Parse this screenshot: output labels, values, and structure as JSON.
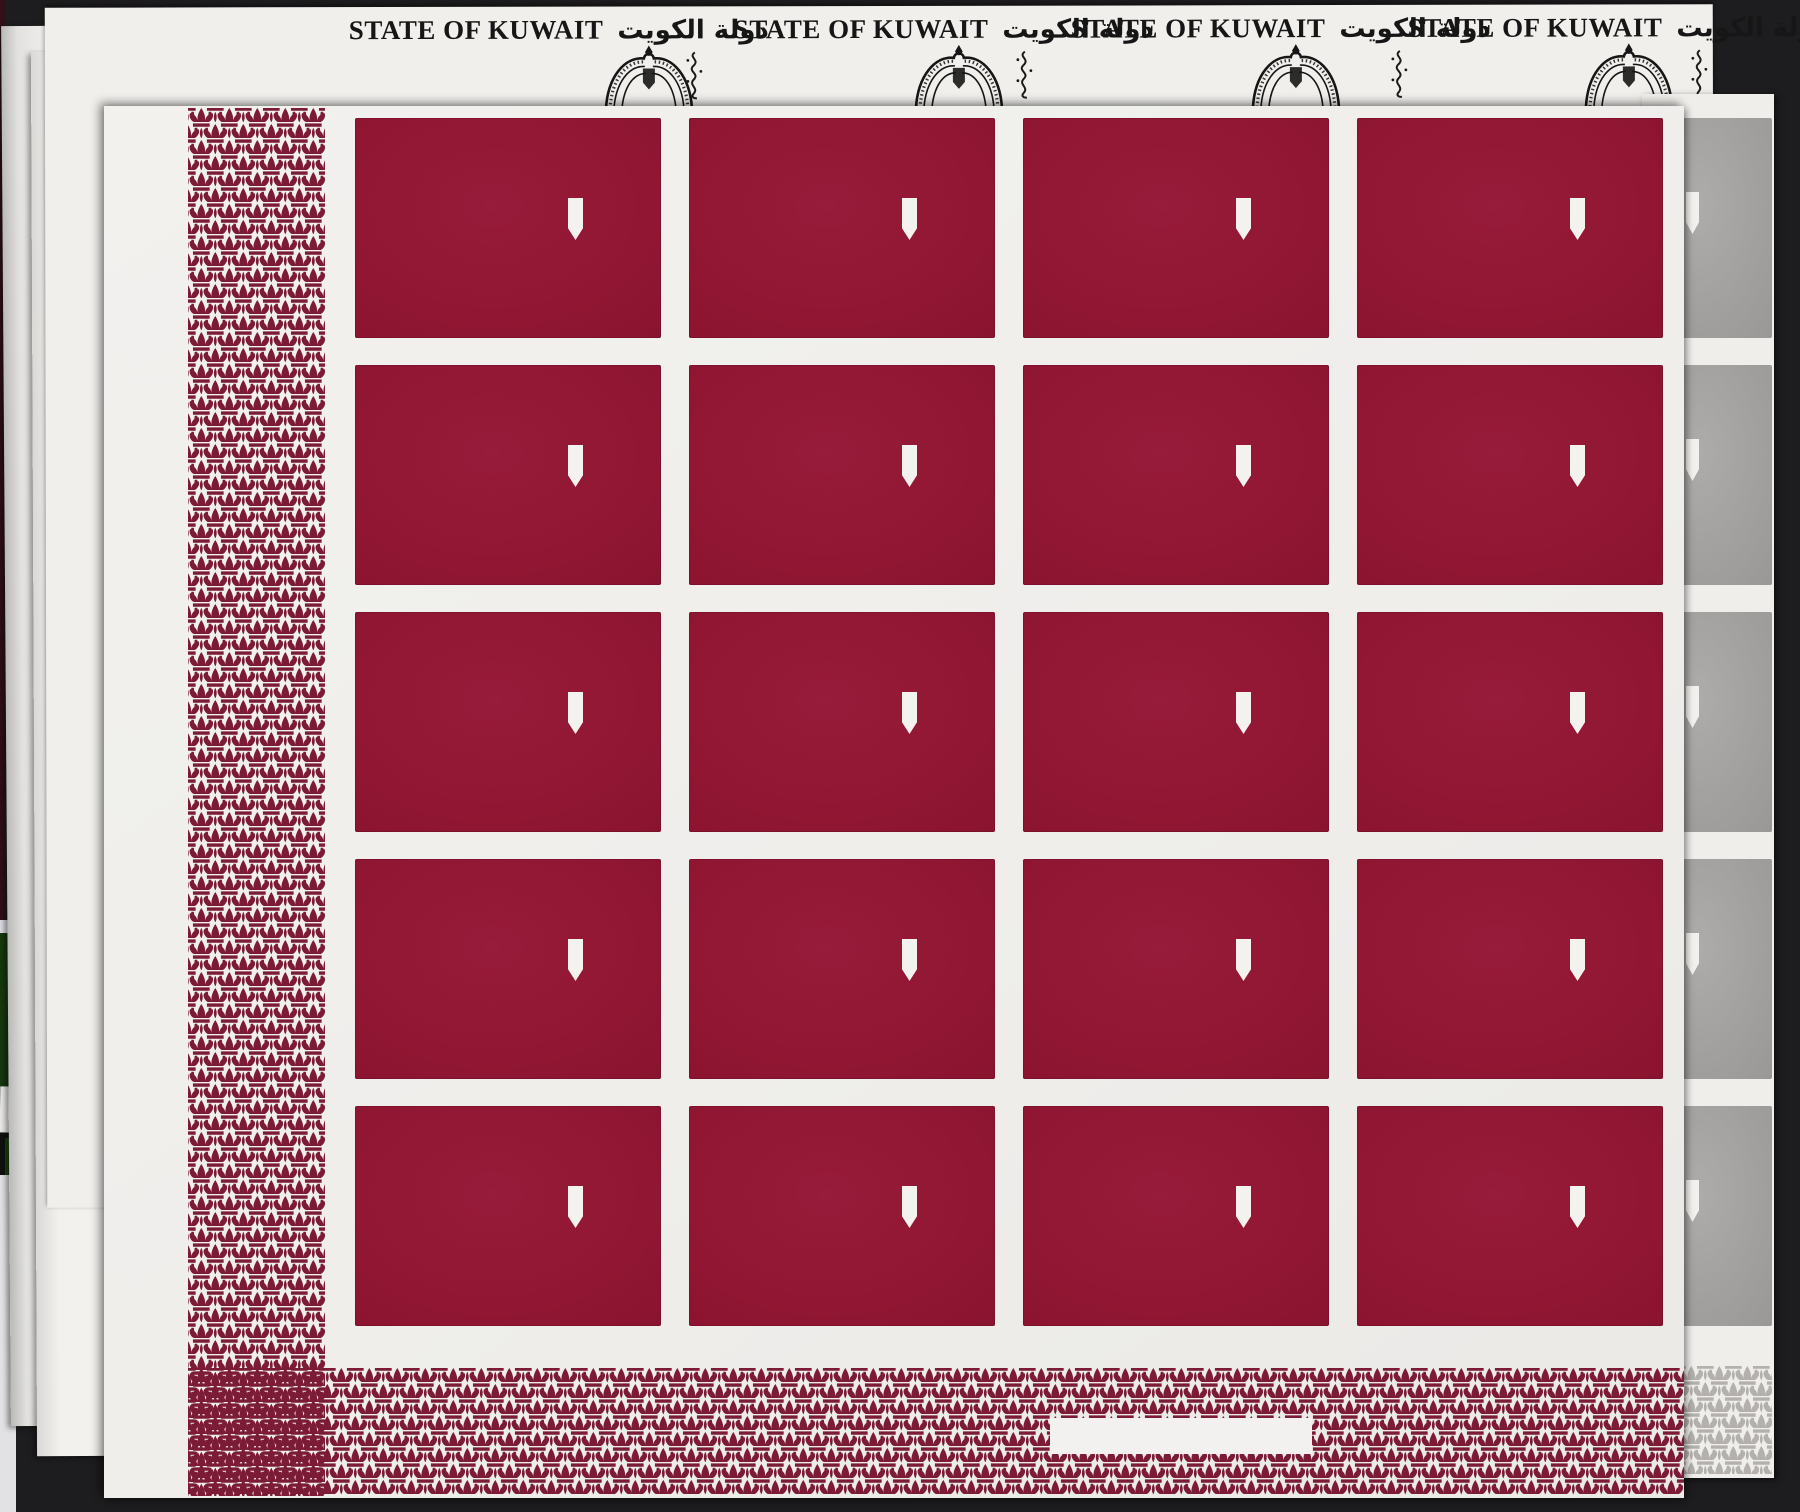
{
  "top_banner": {
    "repeat_count": 4,
    "headers": [
      {
        "title": "STATE OF KUWAIT",
        "title_arabic": "دولة الكويت"
      },
      {
        "title": "STATE OF KUWAIT",
        "title_arabic": "دولة الكويت"
      },
      {
        "title": "STATE OF KUWAIT",
        "title_arabic": "دولة الكويت"
      },
      {
        "title": "STATE OF KUWAIT",
        "title_arabic": "دولة الكويت"
      }
    ]
  },
  "proof_sheet": {
    "stamp_rows": 5,
    "stamp_columns": 4,
    "stamp_count": 20,
    "label_text": "",
    "colors": {
      "stamp_maroon": "#8e1531",
      "fleur_pattern": "#7c1b36",
      "paper": "#f0efec",
      "shield_watermark": "#f3f2ef"
    }
  },
  "under_sheets": {
    "silver_stamp_color": "#9d9b99",
    "silver_pattern_color": "#b3b0ae",
    "green_edge_color": "#1a430f"
  }
}
